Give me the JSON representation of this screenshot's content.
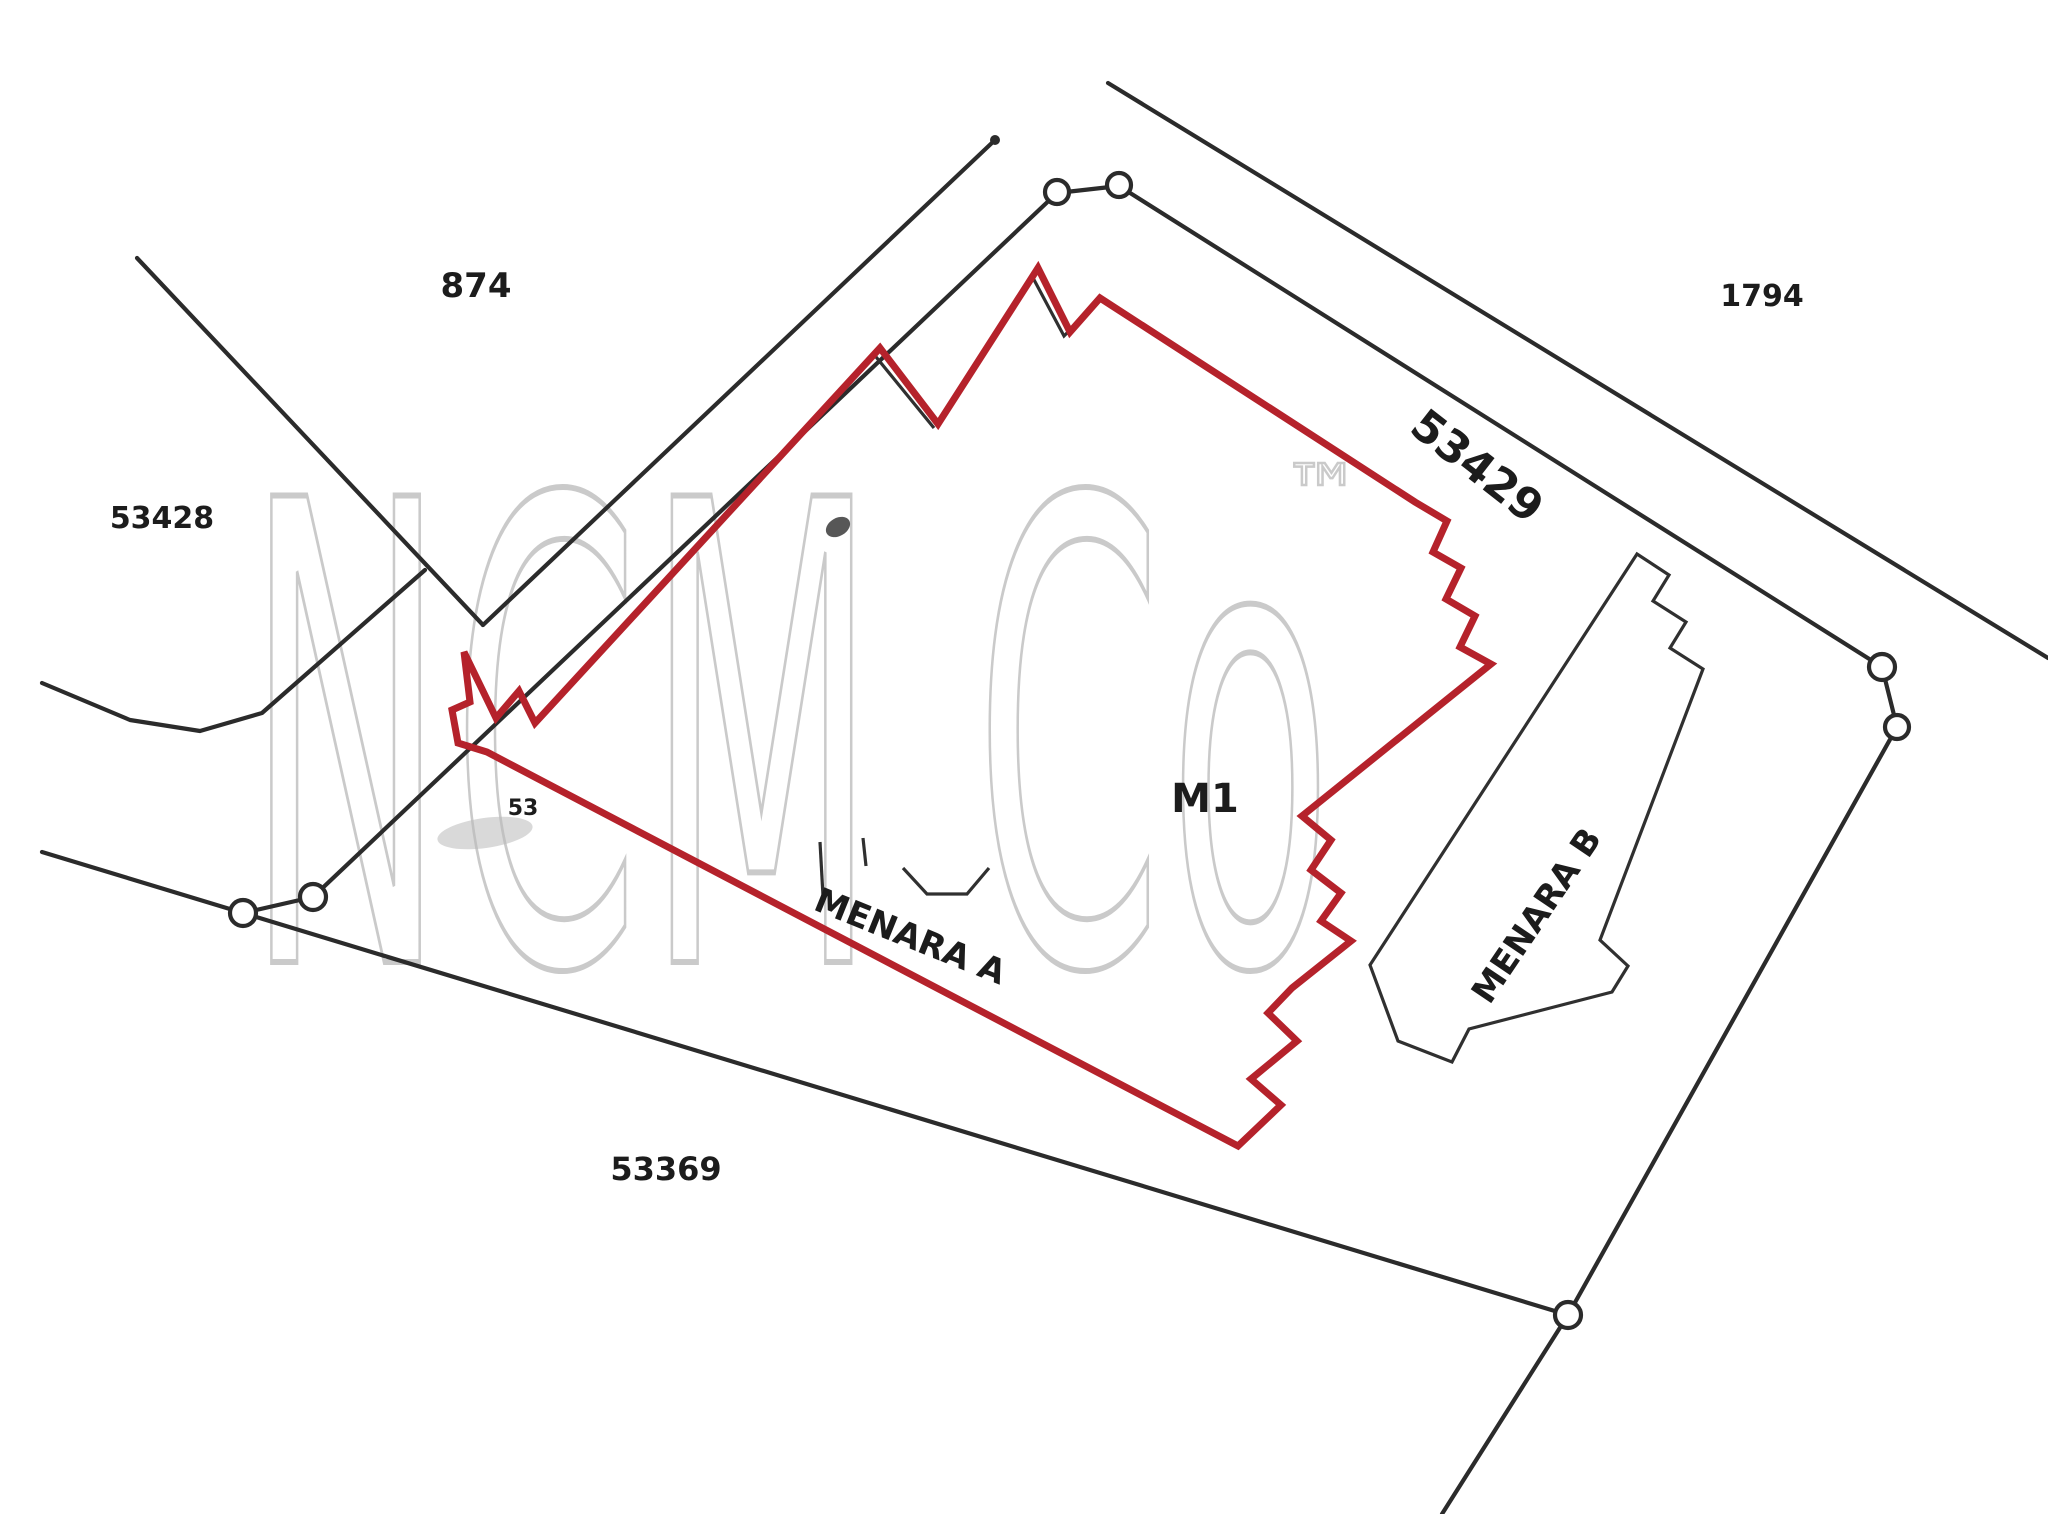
{
  "document": {
    "type": "cadastral-survey-site-plan",
    "background": "#ffffff"
  },
  "colors": {
    "boundary": "#2b2b2b",
    "building": "#303030",
    "red_outline": "#b5222b",
    "watermark": "#bdbdbd",
    "label": "#1c1c1c",
    "artifact": "#b9b9b9"
  },
  "watermark": {
    "text": "NCM Co",
    "tm": "™",
    "x": 245,
    "y": 962,
    "font_size": 640,
    "x_scale": 0.42,
    "tm_x": 1283,
    "tm_y": 520,
    "tm_size": 78
  },
  "labels": [
    {
      "id": "lot-874-label",
      "text": "874",
      "x": 476,
      "y": 297,
      "size": 34,
      "rotate": 0
    },
    {
      "id": "lot-53428-label",
      "text": "53428",
      "x": 162,
      "y": 528,
      "size": 30,
      "rotate": 0
    },
    {
      "id": "lot-1794-label",
      "text": "1794",
      "x": 1762,
      "y": 306,
      "size": 30,
      "rotate": 0
    },
    {
      "id": "road-53429-label",
      "text": "53429",
      "x": 1468,
      "y": 478,
      "size": 44,
      "rotate": 38
    },
    {
      "id": "m1-label",
      "text": "M1",
      "x": 1205,
      "y": 812,
      "size": 40,
      "rotate": 0
    },
    {
      "id": "menara-a-label",
      "text": "MENARA A",
      "x": 906,
      "y": 947,
      "size": 34,
      "rotate": 22
    },
    {
      "id": "menara-b-label",
      "text": "MENARA B",
      "x": 1546,
      "y": 922,
      "size": 34,
      "rotate": -56
    },
    {
      "id": "road-53369-label",
      "text": "53369",
      "x": 666,
      "y": 1180,
      "size": 32,
      "rotate": 0
    },
    {
      "id": "small-annotation-53",
      "text": "53",
      "x": 523,
      "y": 815,
      "size": 22,
      "rotate": 0
    }
  ],
  "boundary_lines": [
    {
      "id": "lot-874-southwest-boundary",
      "points": "137,258 483,625"
    },
    {
      "id": "lot-874-southeast-boundary",
      "points": "483,625 995,140"
    },
    {
      "id": "road-west-edge",
      "points": "42,683 130,720 200,731 262,713 425,570"
    },
    {
      "id": "road-53369-north-edge",
      "points": "42,852 243,913 1568,1315"
    },
    {
      "id": "road-53369-continuation",
      "points": "1568,1315 1442,1514"
    },
    {
      "id": "main-lot-northwest-boundary",
      "points": "313,897 1057,193"
    },
    {
      "id": "main-lot-northeast-boundary",
      "points": "1119,186 1882,667"
    },
    {
      "id": "main-lot-east-boundary",
      "points": "1897,727 1568,1315"
    },
    {
      "id": "lot-1794-road-boundary",
      "points": "1108,83 2048,658"
    },
    {
      "id": "marker-link-top",
      "points": "1057,193 1119,186"
    },
    {
      "id": "marker-link-west",
      "points": "243,913 313,897"
    },
    {
      "id": "marker-link-east",
      "points": "1882,667 1897,727"
    }
  ],
  "survey_markers": [
    {
      "x": 243,
      "y": 913,
      "r": 13
    },
    {
      "x": 313,
      "y": 897,
      "r": 13
    },
    {
      "x": 1057,
      "y": 192,
      "r": 12
    },
    {
      "x": 1119,
      "y": 185,
      "r": 12
    },
    {
      "x": 1882,
      "y": 667,
      "r": 13
    },
    {
      "x": 1897,
      "y": 727,
      "r": 12
    },
    {
      "x": 1568,
      "y": 1315,
      "r": 13
    }
  ],
  "line_terminus_dot": {
    "x": 995,
    "y": 140,
    "r": 5
  },
  "red_strata_outline": {
    "points": "1038,268 1070,332 1100,298 1415,502 1447,521 1433,552 1461,568 1446,599 1475,616 1460,647 1491,664 1302,816 1331,840 1311,870 1341,893 1321,921 1351,941 1292,988 1268,1013 1297,1041 1251,1079 1281,1105 1238,1146 487,752 458,743 452,710 470,702 464,652 496,718 519,691 535,723 880,348 938,424",
    "stroke_width": 7
  },
  "building_outlines": [
    {
      "id": "menara-b-building-outline",
      "points": "1370,965 1637,554 1669,575 1653,601 1686,622 1670,648 1703,669 1600,940 1628,966 1612,992 1469,1029 1452,1062 1398,1041 1370,965",
      "closed": true
    },
    {
      "id": "menara-a-footprint-notch",
      "points": "903,868 927,894 967,894 989,868",
      "closed": false
    },
    {
      "id": "menara-a-footprint-edge-1",
      "points": "820,842 823,896",
      "closed": false
    },
    {
      "id": "menara-a-footprint-edge-2",
      "points": "863,838 866,866",
      "closed": false
    },
    {
      "id": "tower-footprint-shadow-1",
      "points": "872,352 934,428",
      "closed": false
    },
    {
      "id": "tower-footprint-shadow-2",
      "points": "1032,276 1064,336 1096,304",
      "closed": false
    }
  ],
  "scan_artifacts": [
    {
      "id": "dark-smudge",
      "cx": 838,
      "cy": 527,
      "rx": 13,
      "ry": 9,
      "fill": "#3a3a3a",
      "opacity": 0.85,
      "rotate": -30
    },
    {
      "id": "gray-smudge",
      "cx": 485,
      "cy": 833,
      "rx": 48,
      "ry": 15,
      "fill": "#b9b9b9",
      "opacity": 0.55,
      "rotate": -8
    }
  ]
}
